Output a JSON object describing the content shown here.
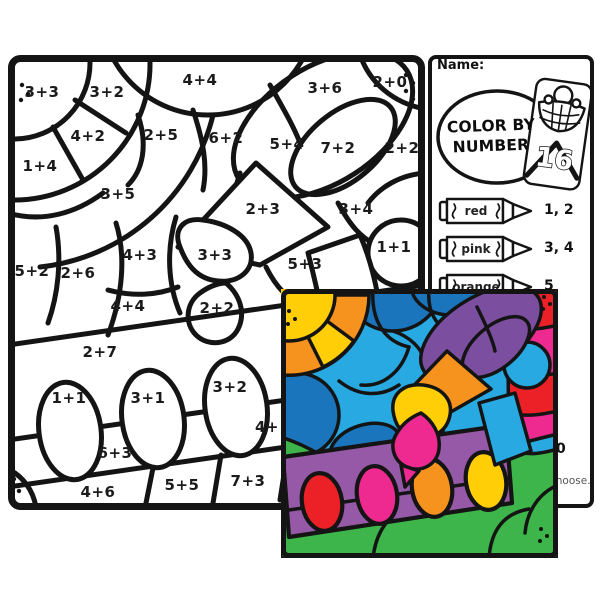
{
  "palette": {
    "red": "#EC2027",
    "magenta": "#EE2A90",
    "orange": "#F6921E",
    "yellow": "#FFCE07",
    "green": "#3DB54A",
    "light_blue": "#29A9E1",
    "dark_blue": "#1B75BC",
    "purple_dark": "#7B4EA0",
    "purple_light": "#9659A7",
    "line": "#141414"
  },
  "bw_page": {
    "problems": [
      {
        "t": "3+3",
        "x": 34,
        "y": 37
      },
      {
        "t": "3+2",
        "x": 99,
        "y": 37
      },
      {
        "t": "4+4",
        "x": 192,
        "y": 25
      },
      {
        "t": "3+6",
        "x": 317,
        "y": 33
      },
      {
        "t": "2+0",
        "x": 382,
        "y": 27
      },
      {
        "t": "4+2",
        "x": 80,
        "y": 81
      },
      {
        "t": "2+5",
        "x": 153,
        "y": 80
      },
      {
        "t": "6+2",
        "x": 218,
        "y": 83
      },
      {
        "t": "5+4",
        "x": 279,
        "y": 89
      },
      {
        "t": "7+2",
        "x": 330,
        "y": 93
      },
      {
        "t": "2+2",
        "x": 394,
        "y": 93
      },
      {
        "t": "1+4",
        "x": 32,
        "y": 111
      },
      {
        "t": "3+5",
        "x": 110,
        "y": 139
      },
      {
        "t": "2+3",
        "x": 255,
        "y": 154
      },
      {
        "t": "3+4",
        "x": 348,
        "y": 154
      },
      {
        "t": "1+1",
        "x": 386,
        "y": 192
      },
      {
        "t": "4+3",
        "x": 132,
        "y": 200
      },
      {
        "t": "3+3",
        "x": 207,
        "y": 200
      },
      {
        "t": "5+3",
        "x": 297,
        "y": 209
      },
      {
        "t": "5+2",
        "x": 24,
        "y": 216
      },
      {
        "t": "2+6",
        "x": 70,
        "y": 218
      },
      {
        "t": "4+4",
        "x": 120,
        "y": 251
      },
      {
        "t": "2+2",
        "x": 209,
        "y": 253
      },
      {
        "t": "2+7",
        "x": 92,
        "y": 297
      },
      {
        "t": "1+1",
        "x": 61,
        "y": 343
      },
      {
        "t": "3+1",
        "x": 140,
        "y": 343
      },
      {
        "t": "3+2",
        "x": 222,
        "y": 332
      },
      {
        "t": "4+",
        "x": 259,
        "y": 372
      },
      {
        "t": "6+3",
        "x": 107,
        "y": 398
      },
      {
        "t": "4+6",
        "x": 90,
        "y": 437
      },
      {
        "t": "5+5",
        "x": 174,
        "y": 430
      },
      {
        "t": "7+3",
        "x": 240,
        "y": 426
      }
    ]
  },
  "key_page": {
    "name_label": "Name:",
    "logo": {
      "line1": "COLOR BY",
      "line2": "NUMBER",
      "box_count": "16"
    },
    "legend": [
      {
        "color_name": "red",
        "numbers": "1, 2"
      },
      {
        "color_name": "pink",
        "numbers": "3, 4"
      },
      {
        "color_name": "orange",
        "numbers": "5"
      }
    ],
    "partial_texts": [
      {
        "t": "0",
        "x": 128,
        "y": 386,
        "cls": "frag-bold"
      },
      {
        "t": "choose.",
        "x": 122,
        "y": 420,
        "cls": "frag-gray"
      }
    ]
  }
}
